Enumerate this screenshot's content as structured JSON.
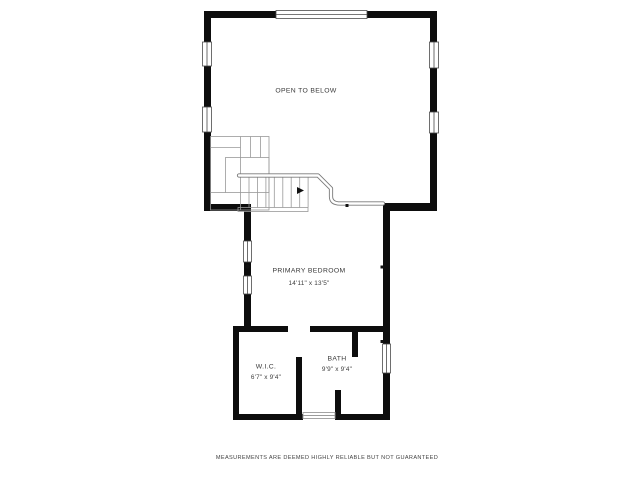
{
  "plan": {
    "rooms": {
      "open_below": {
        "label": "OPEN TO BELOW",
        "dims": ""
      },
      "primary_bedroom": {
        "label": "PRIMARY BEDROOM",
        "dims": "14'11\" x 13'5\""
      },
      "wic": {
        "label": "W.I.C.",
        "dims": "6'7\" x 9'4\""
      },
      "bath": {
        "label": "BATH",
        "dims": "9'9\" x 9'4\""
      }
    },
    "footer": "MEASUREMENTS ARE DEEMED HIGHLY RELIABLE BUT NOT GUARANTEED",
    "colors": {
      "wall": "#0d0d0d",
      "background": "#ffffff",
      "stair_line": "#999999",
      "railing": "#7a7a7a",
      "window_outline": "#4a4a4a",
      "text": "#383838"
    }
  }
}
